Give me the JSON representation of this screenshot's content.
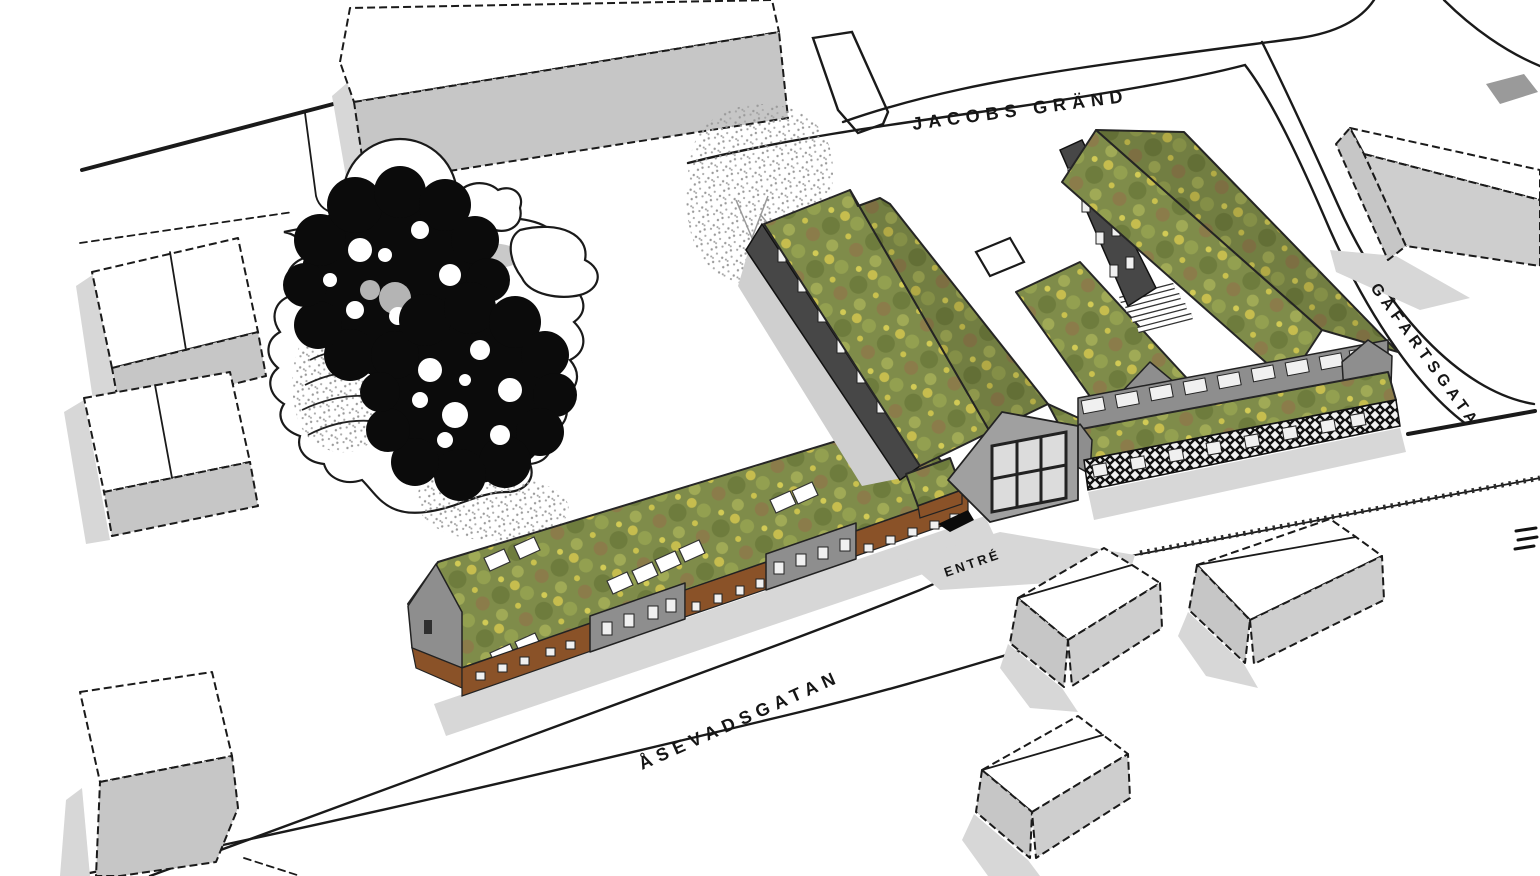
{
  "scene": {
    "type": "architectural-site-plan-axonometric",
    "description": "Aerial SketchUp-style rendering of a proposed housing block with green sedum roofs, wood and dark facades, surrounded by white context buildings, dark sketched trees, a terraced park and labelled streets"
  },
  "labels": {
    "street_top": "JACOBS GRÄND",
    "street_right": "GÅFARTSGATA",
    "street_bottom": "ÅSEVADSGATAN",
    "entrance": "ENTRÉ"
  },
  "colors": {
    "green_roof": "#7f8c4a",
    "green_roof_light": "#9aa654",
    "green_roof_yellow": "#c9c14e",
    "facade_wood_brown": "#8a5228",
    "facade_dark": "#474747",
    "facade_gray": "#8e8e8e",
    "context_wall_gray": "#c6c6c6",
    "shadow_gray": "#d7d7d7",
    "line_black": "#1a1a1a",
    "ground_white": "#ffffff"
  }
}
